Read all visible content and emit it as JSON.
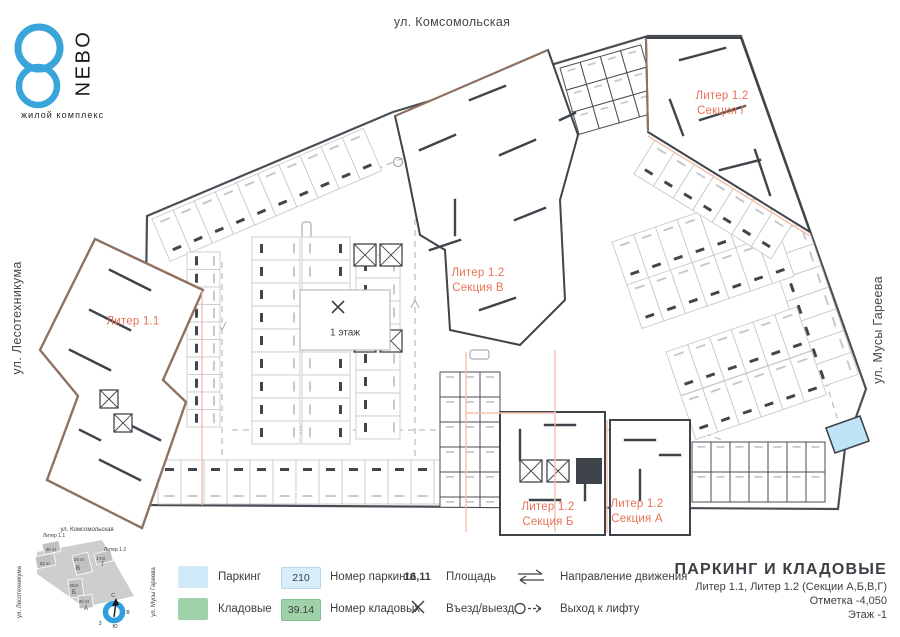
{
  "logo": {
    "name": "NEBO",
    "tagline": "жилой комплекс"
  },
  "streets": {
    "top": "ул. Комсомольская",
    "left": "ул. Лесотехникума",
    "right": "ул. Мусы Гареева"
  },
  "plan": {
    "liter11": "Литер 1.1",
    "section_g": {
      "line1": "Литер 1.2",
      "line2": "Секция Г"
    },
    "section_v": {
      "line1": "Литер 1.2",
      "line2": "Секция В"
    },
    "section_b": {
      "line1": "Литер 1.2",
      "line2": "Секция Б"
    },
    "section_a": {
      "line1": "Литер 1.2",
      "line2": "Секция А"
    },
    "floor_label": "1 этаж"
  },
  "minimap": {
    "street_top": "ул. Комсомольская",
    "street_left": "ул. Лесотехникума",
    "street_right": "ул. Мусы Гареева",
    "liter11": "Литер 1.1",
    "liter12": "Литер 1.2",
    "buildings": [
      {
        "floors": "30 эт",
        "letter": ""
      },
      {
        "floors": "32 эт",
        "letter": ""
      },
      {
        "floors": "24 эт",
        "letter": "В"
      },
      {
        "floors": "17эт",
        "letter": "Г"
      },
      {
        "floors": "20эт",
        "letter": "Б"
      },
      {
        "floors": "20 эт",
        "letter": "А"
      }
    ],
    "compass": {
      "north": "С",
      "east": "В",
      "south": "Ю",
      "west": "З"
    }
  },
  "legend": {
    "parking_label": "Паркинг",
    "storage_label": "Кладовые",
    "parking_number": "210",
    "parking_number_label": "Номер паркинга",
    "storage_number": "39.14",
    "storage_number_label": "Номер кладовых",
    "area_value": "16,11",
    "area_label": "Площадь",
    "entry_label": "Въезд/выезд",
    "direction_label": "Направление движения",
    "elevator_label": "Выход к лифту"
  },
  "titleblock": {
    "title": "ПАРКИНГ И КЛАДОВЫЕ",
    "subtitle": "Литер 1.1, Литер 1.2 (Секции А,Б,В,Г)",
    "elevation": "Отметка  -4,050",
    "floor": "Этаж  -1"
  },
  "colors": {
    "accent": "#e87358",
    "parking_fill": "#cfe9f9",
    "storage_fill": "#9fd2a9",
    "logo_blue": "#3aa5db",
    "wall": "#41464c",
    "brown_outline": "#8f7262",
    "salmon_line": "#f4c0ac"
  }
}
